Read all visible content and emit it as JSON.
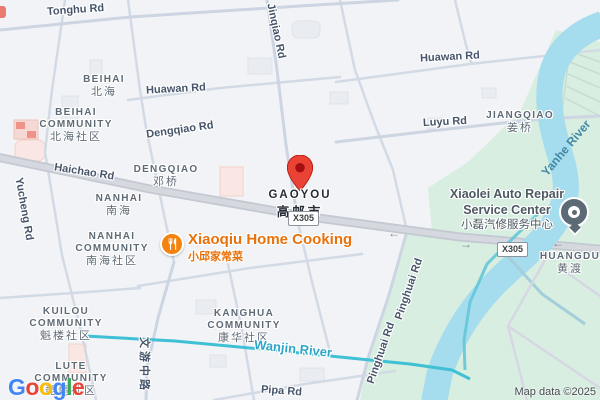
{
  "map_title": "Gaoyou city map",
  "marker": {
    "name": "GAOYOU",
    "zh": "高邮市"
  },
  "route_badges": {
    "center": "X305",
    "right": "X305"
  },
  "roads": {
    "tonghu": "Tonghu Rd",
    "jinqiao": "Jinqiao Rd",
    "huawan_left": "Huawan Rd",
    "huawan_right": "Huawan Rd",
    "dengqiao": "Dengqiao Rd",
    "haichao": "Haichao Rd",
    "yucheng": "Yucheng Rd",
    "luyu": "Luyu Rd",
    "pinghuai_upper": "Pinghuai Rd",
    "pinghuai_lower": "Pinghuai Rd",
    "pipa": "Pipa Rd",
    "wenyou": "文游中路"
  },
  "areas": {
    "beihai": {
      "name": "BEIHAI",
      "zh": "北海"
    },
    "beihai_community": {
      "line1": "BEIHAI",
      "line2": "COMMUNITY",
      "zh": "北海社区"
    },
    "dengqiao": {
      "name": "DENGQIAO",
      "zh": "邓桥"
    },
    "nanhai": {
      "name": "NANHAI",
      "zh": "南海"
    },
    "nanhai_community": {
      "line1": "NANHAI",
      "line2": "COMMUNITY",
      "zh": "南海社区"
    },
    "kuilou_community": {
      "line1": "KUILOU",
      "line2": "COMMUNITY",
      "zh": "魁楼社区"
    },
    "lute_community": {
      "line1": "LUTE",
      "line2": "COMMUNITY",
      "zh": "琵琶社区"
    },
    "kanghua_community": {
      "line1": "KANGHUA",
      "line2": "COMMUNITY",
      "zh": "康华社区"
    },
    "jiangqiao": {
      "name": "JIANGQIAO",
      "zh": "姜桥"
    },
    "huangdu": {
      "name": "HUANGDU",
      "zh": "黄渡"
    }
  },
  "waterways": {
    "wanjin": "Wanjin River",
    "yanhe": "Yanhe River"
  },
  "pois": {
    "xiaoqiu": {
      "name": "Xiaoqiu Home Cooking",
      "zh": "小邱家常菜",
      "icon": "restaurant-icon"
    },
    "xiaolei": {
      "line1": "Xiaolei Auto Repair",
      "line2": "Service Center",
      "zh": "小磊汽修服务中心",
      "icon": "circle-poi-icon"
    }
  },
  "arrows": {
    "left": "←",
    "right": "→"
  },
  "attribution": {
    "text": "Map data ©2025"
  },
  "logo": {
    "letters": [
      {
        "ch": "G",
        "color": "#4285F4"
      },
      {
        "ch": "o",
        "color": "#EA4335"
      },
      {
        "ch": "o",
        "color": "#FBBC05"
      },
      {
        "ch": "g",
        "color": "#4285F4"
      },
      {
        "ch": "l",
        "color": "#34A853"
      },
      {
        "ch": "e",
        "color": "#EA4335"
      }
    ]
  },
  "colors": {
    "marker_red": "#EA4335",
    "marker_red_dark": "#A50E0E",
    "poi_orange": "#F5820D",
    "poi_orange_text": "#E8710A",
    "poi_gray": "#5B6A74",
    "water_fill": "#A5DDEF",
    "canal": "#3FC0D5",
    "green_area": "#D7EEE0",
    "main_road": "#C3C8D1",
    "road_label": "#46556B",
    "area_label": "#5E6A76",
    "water_label": "#2EA6C9"
  }
}
